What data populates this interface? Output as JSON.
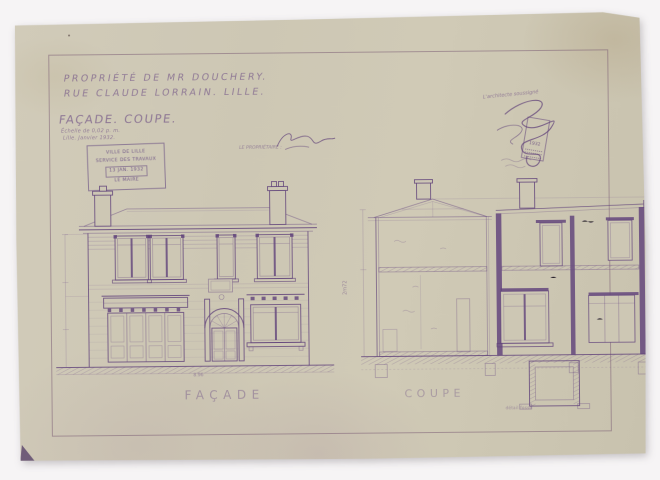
{
  "titleblock": {
    "line1": "PROPRIÉTÉ DE MR DOUCHERY.",
    "line2": "RUE CLAUDE LORRAIN. LILLE.",
    "subtitle": "FAÇADE. COUPE.",
    "scale_note": "Échelle de 0,02 p. m.",
    "date_note": "Lille. Janvier 1932."
  },
  "approval_stamp": {
    "line1": "VILLE DE LILLE",
    "line2": "SERVICE DES TRAVAUX",
    "date": "13 JAN. 1932",
    "line4": "LE MAIRE"
  },
  "signatures": {
    "proprietor_label": "LE PROPRIÉTAIRE :",
    "architect_label": "L'architecte soussigné",
    "revenue_stamp_year": "1932"
  },
  "facade": {
    "label": "FAÇADE",
    "width_dim": "8.96"
  },
  "coupe": {
    "label": "COUPE",
    "height_dim": "2m72",
    "detail_caption": "détail fosse"
  },
  "colors": {
    "paper": "#cdc7b4",
    "ink": "#6a4a82",
    "background": "#f6f4f5"
  }
}
